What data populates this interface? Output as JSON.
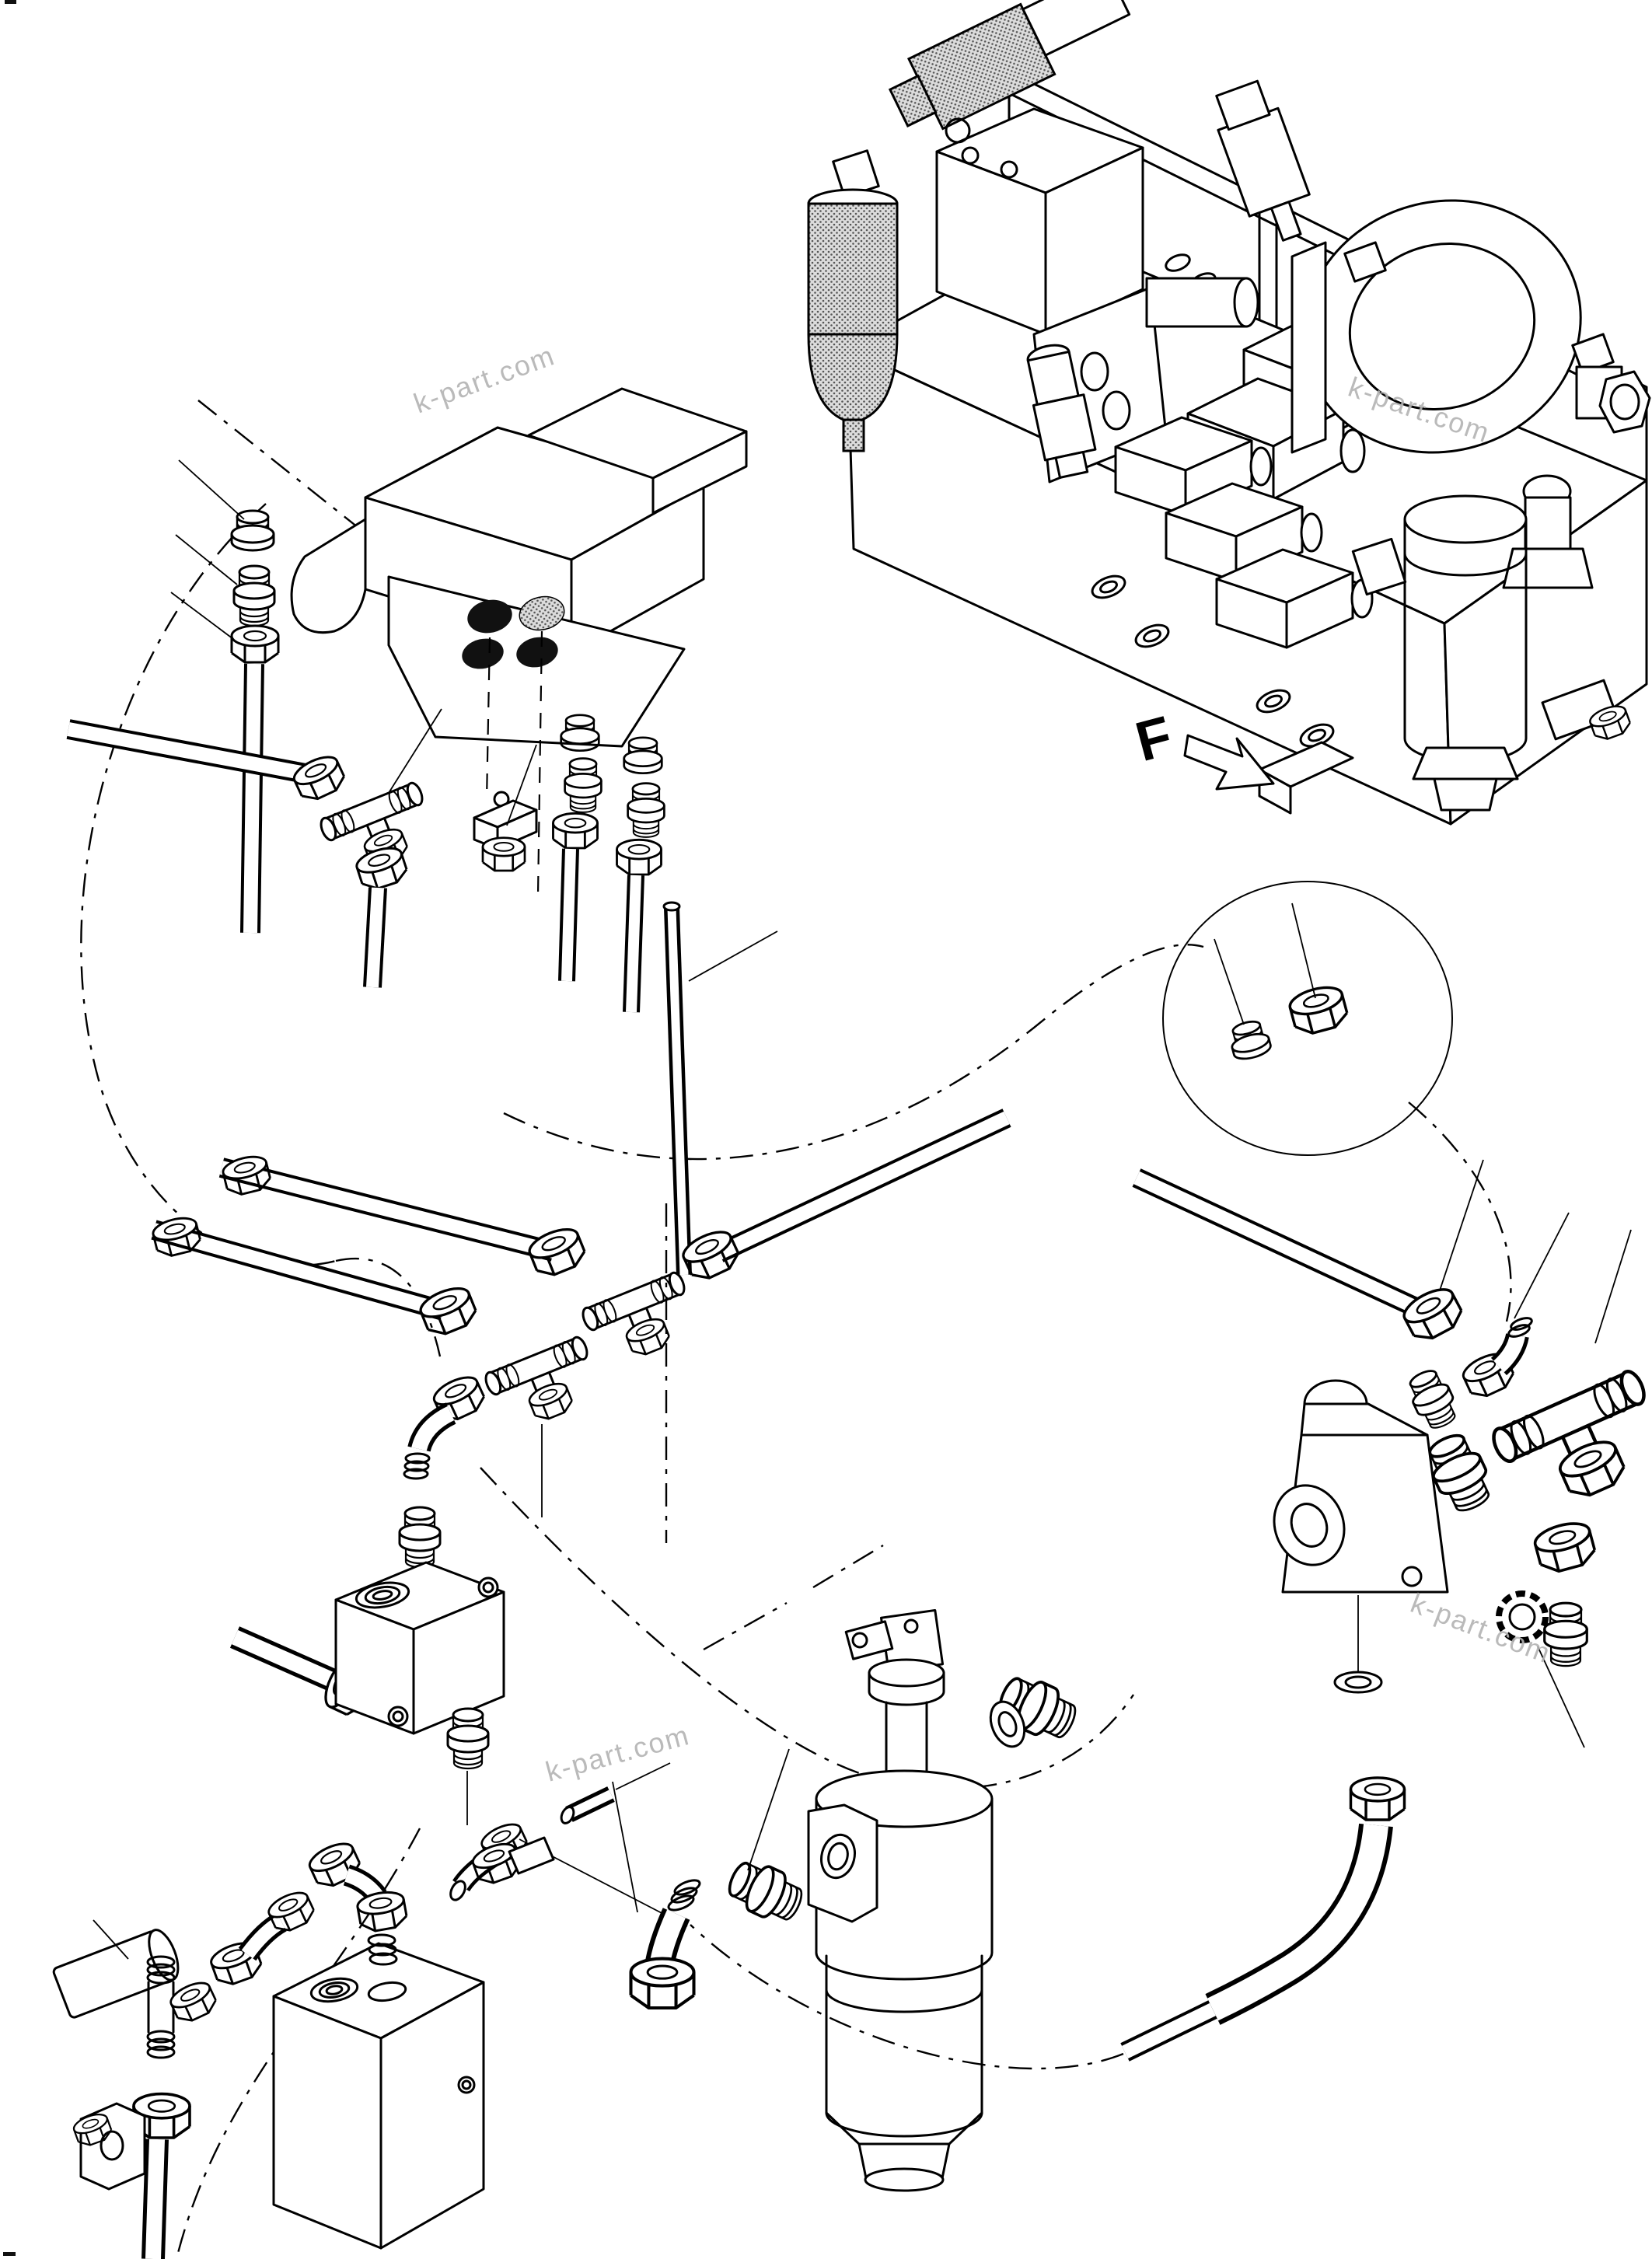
{
  "canvas": {
    "background": "#ffffff",
    "line_color": "#000000",
    "port_black": "#111111",
    "hatch_gray": "#d8d8d8",
    "watermark_color": "#b3b3b3",
    "registration_mark_color": "#111111"
  },
  "direction_indicator": {
    "label": "F"
  },
  "watermark": {
    "text": "k-part.com",
    "color": "#b3b3b3"
  }
}
